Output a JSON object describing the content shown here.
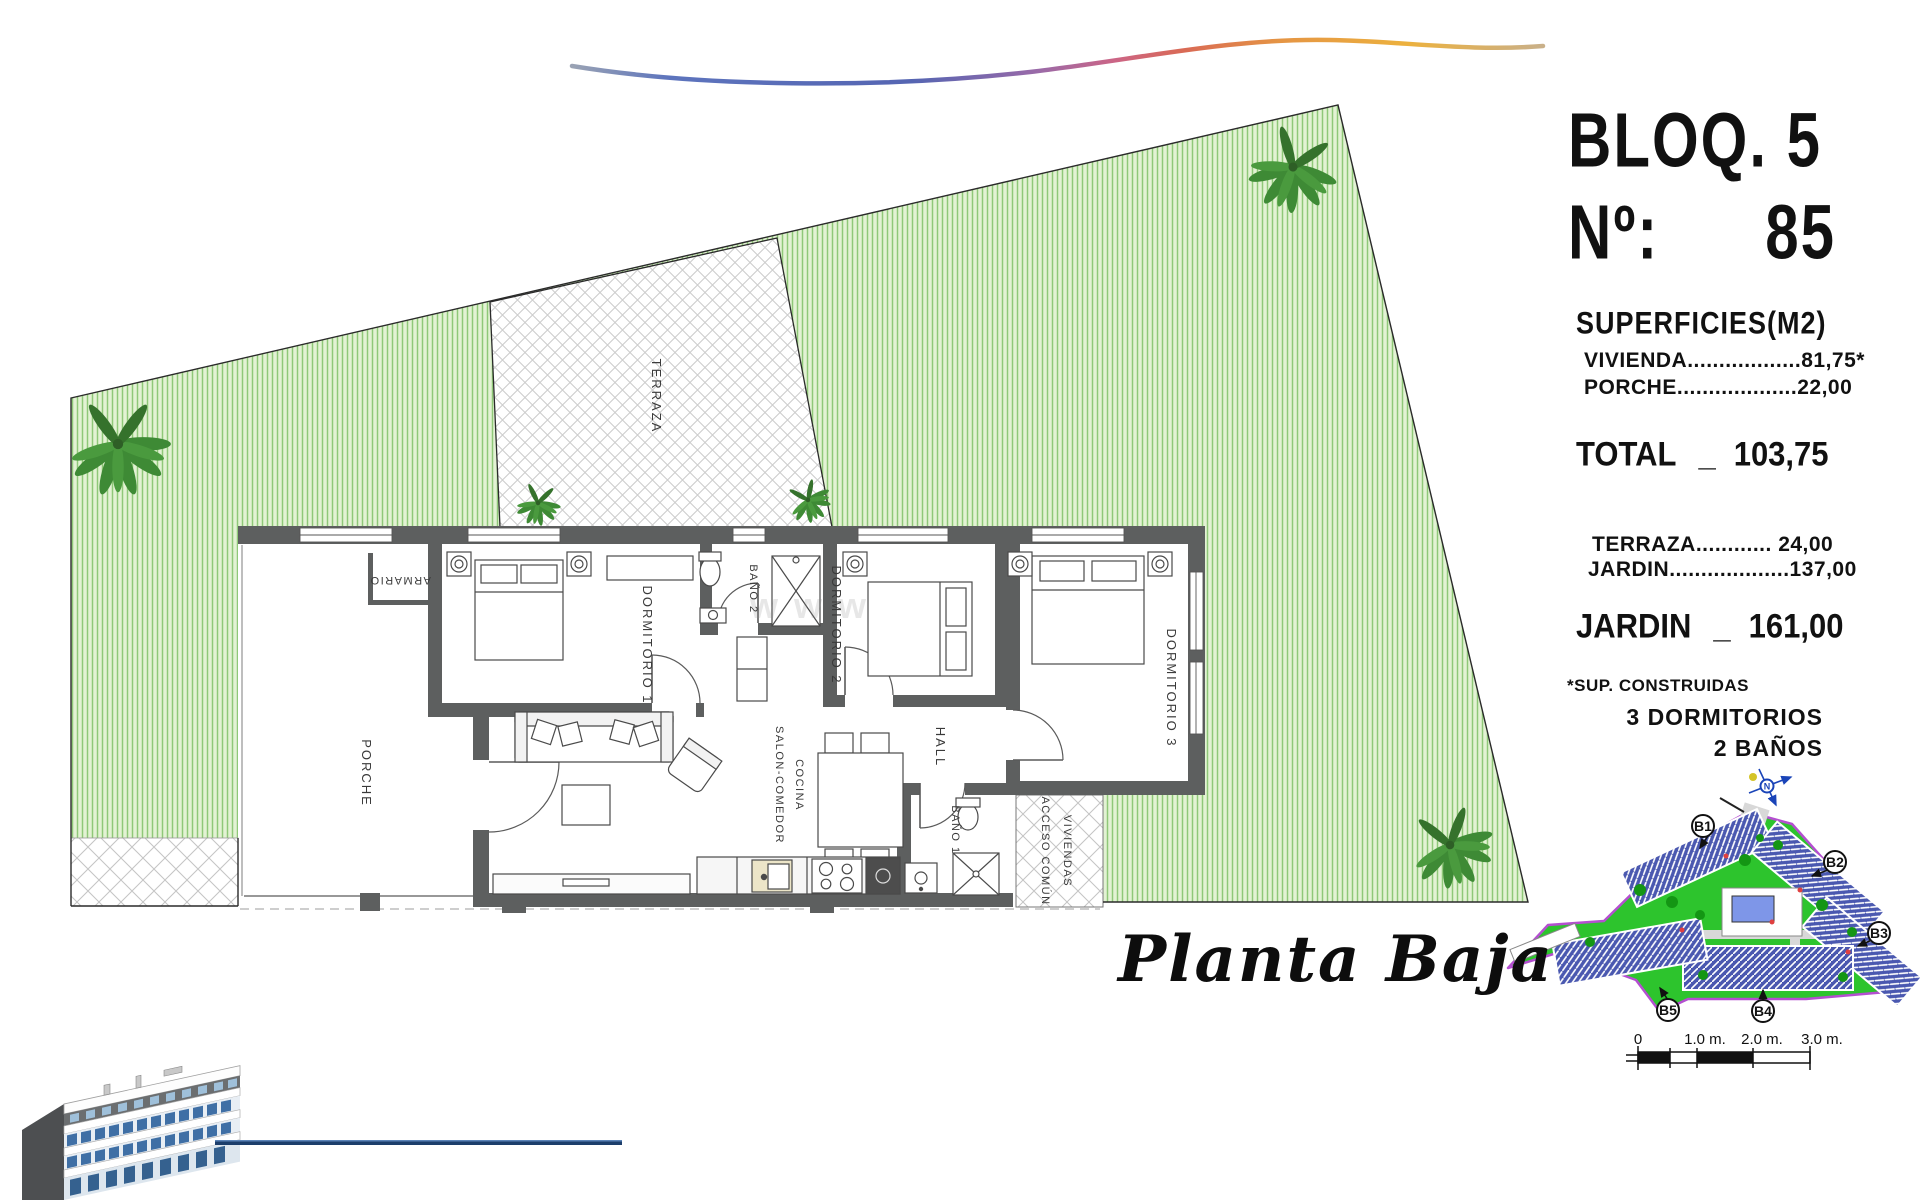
{
  "header": {
    "block": "BLOQ. 5",
    "no_label": "Nº:",
    "number": "85"
  },
  "surfaces": {
    "title": "SUPERFICIES(M2)",
    "rows": [
      {
        "label": "VIVIENDA",
        "dots": "..................",
        "value": "81,75*"
      },
      {
        "label": "PORCHE",
        "dots": "...................",
        "value": "22,00"
      }
    ],
    "total": {
      "label": "TOTAL",
      "sep": "_",
      "value": "103,75"
    }
  },
  "exterior": {
    "rows": [
      {
        "label": "TERRAZA",
        "dots": "............",
        "value": "24,00"
      },
      {
        "label": "JARDIN",
        "dots": "...................",
        "value": "137,00"
      }
    ],
    "total": {
      "label": "JARDIN",
      "sep": "_",
      "value": "161,00"
    }
  },
  "footnote": "*SUP. CONSTRUIDAS",
  "features": {
    "bedrooms": "3 DORMITORIOS",
    "bathrooms": "2 BAÑOS"
  },
  "plan": {
    "title": "Planta Baja",
    "watermark": "www",
    "rooms": {
      "terraza": "TERRAZA",
      "porche": "PORCHE",
      "armario": "ARMARIO",
      "dormitorio1": "DORMITORIO 1",
      "dormitorio2": "DORMITORIO 2",
      "dormitorio3": "DORMITORIO 3",
      "bano1": "BAÑO 1",
      "bano2": "BAÑO 2",
      "hall": "HALL",
      "salon_line1": "SALON-COMEDOR",
      "salon_line2": "COCINA",
      "acceso_line1": "ACCESO COMÚN",
      "acceso_line2": "VIVIENDAS"
    }
  },
  "site_map": {
    "labels": {
      "b1": "B1",
      "b2": "B2",
      "b3": "B3",
      "b4": "B4",
      "b5": "B5"
    },
    "compass": "N"
  },
  "scale_bar": {
    "t0": "0",
    "t1": "1.0 m.",
    "t2": "2.0 m.",
    "t3": "3.0 m."
  },
  "colors": {
    "garden_base": "#e3f2d4",
    "garden_stripe": "#8fc878",
    "wall": "#5d5f5f",
    "map_green": "#2dc42d",
    "map_boundary": "#b44fd0",
    "map_building": "#4a58b0",
    "pool": "#7e96e8",
    "render_window": "#3f6fa5",
    "accent_line": "#1c3e6b"
  }
}
